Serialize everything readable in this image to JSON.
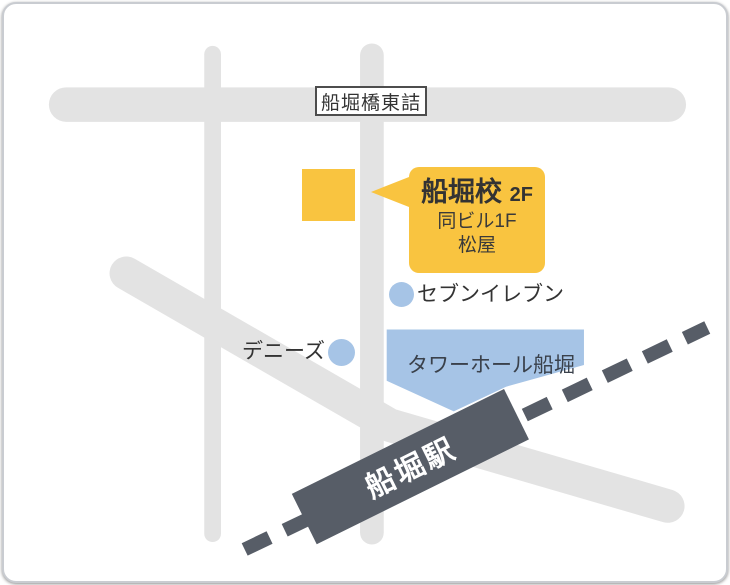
{
  "map": {
    "road_sign": {
      "label": "船堀橋東詰"
    },
    "school_callout": {
      "title": "船堀校",
      "floor": "2F",
      "line2": "同ビル1F",
      "line3": "松屋"
    },
    "pois": [
      {
        "name": "セブンイレブン",
        "marker": "blue-dot"
      },
      {
        "name": "デニーズ",
        "marker": "blue-dot"
      }
    ],
    "buildings": [
      {
        "name": "タワーホール船堀"
      }
    ],
    "station": {
      "name": "船堀駅"
    },
    "colors": {
      "accent_yellow": "#F9C440",
      "poi_blue": "#A6C4E6",
      "rail_dark": "#575D67",
      "road_gray": "#E3E3E3",
      "text_dark": "#333333"
    }
  }
}
